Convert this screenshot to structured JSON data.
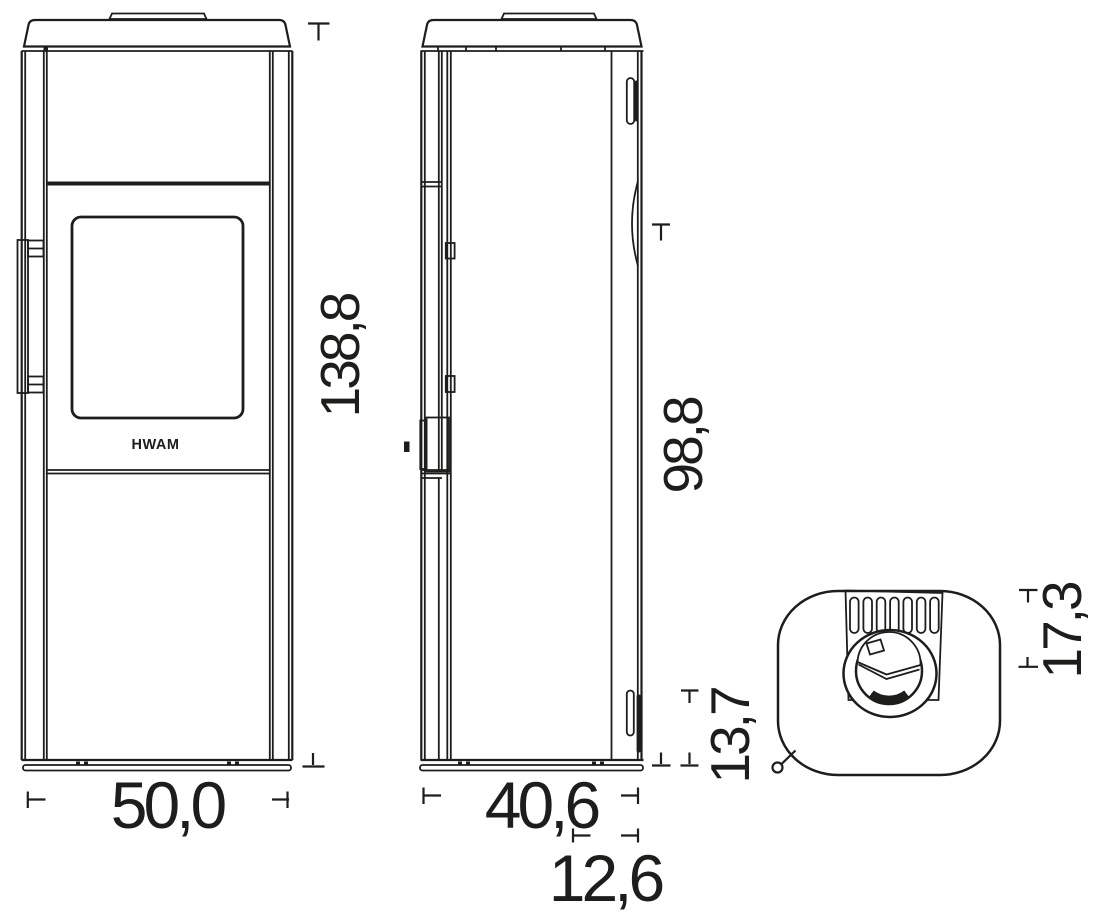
{
  "drawing": {
    "type": "technical-dimension-drawing",
    "subject": "wood-burning-stove",
    "brand": "HWAM",
    "line_color": "#1d1d1b",
    "background": "#ffffff",
    "front_view": {
      "width_label": "50,0",
      "height_label": "138,8"
    },
    "side_view": {
      "depth_label": "40,6",
      "height_label": "98,8",
      "flue_offset_label": "12,6",
      "intake_height_label": "13,7"
    },
    "top_view": {
      "flue_offset_label": "17,3"
    }
  }
}
